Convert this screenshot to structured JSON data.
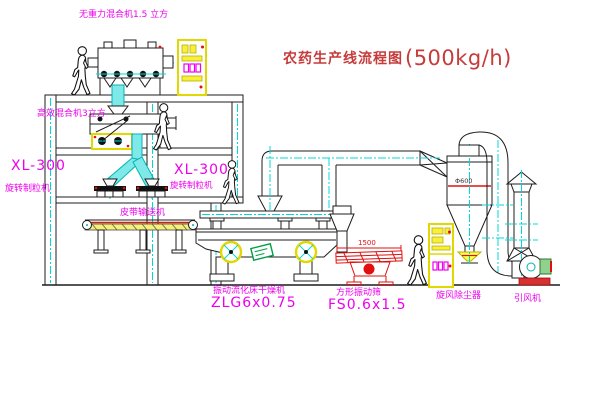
{
  "title": {
    "name": "农药生产线流程图",
    "capacity": "(500kg/h)"
  },
  "equipment": {
    "gravity_mixer": {
      "label": "无重力混合机1.5 立方"
    },
    "high_eff_mixer": {
      "label": "高效混合机3立方"
    },
    "granulator_left": {
      "model": "XL-300",
      "label": "旋转制粒机"
    },
    "granulator_right": {
      "model": "XL-300",
      "label": "旋转制粒机"
    },
    "belt_conveyor": {
      "label": "皮带输送机"
    },
    "fluid_bed_dryer": {
      "label": "振动流化床干燥机",
      "model": "ZLG6x0.75"
    },
    "vibrating_screen": {
      "label": "方形振动筛",
      "model": "FS0.6x1.5",
      "dimension": "1500"
    },
    "cyclone": {
      "label": "旋风除尘器",
      "dimension": "Φ600"
    },
    "draft_fan": {
      "label": "引风机"
    }
  },
  "colors": {
    "label_magenta": "#ee00ee",
    "title_red": "#c73b3b",
    "line_black": "#1c1c1c",
    "centerline_cyan": "#00d8d8",
    "cabinet_yellow": "#f0e800",
    "accent_red": "#e01010",
    "stamp_green": "#00a044"
  }
}
